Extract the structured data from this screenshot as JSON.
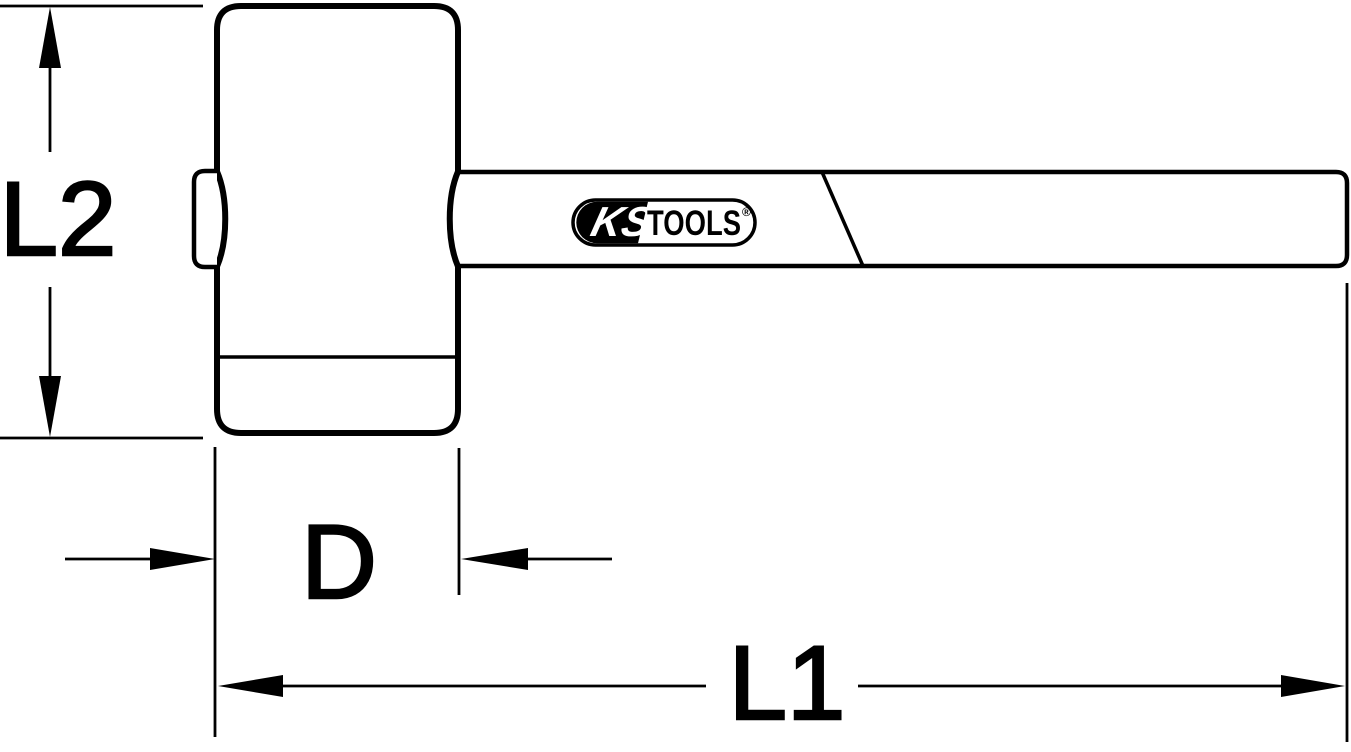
{
  "drawing": {
    "dim_height_label": "L2",
    "dim_diameter_label": "D",
    "dim_length_label": "L1"
  },
  "logo": {
    "brand_left": "KS",
    "brand_right": "TOOLS",
    "registered_mark": "®"
  },
  "colors": {
    "line": "#000000",
    "background": "#ffffff"
  }
}
